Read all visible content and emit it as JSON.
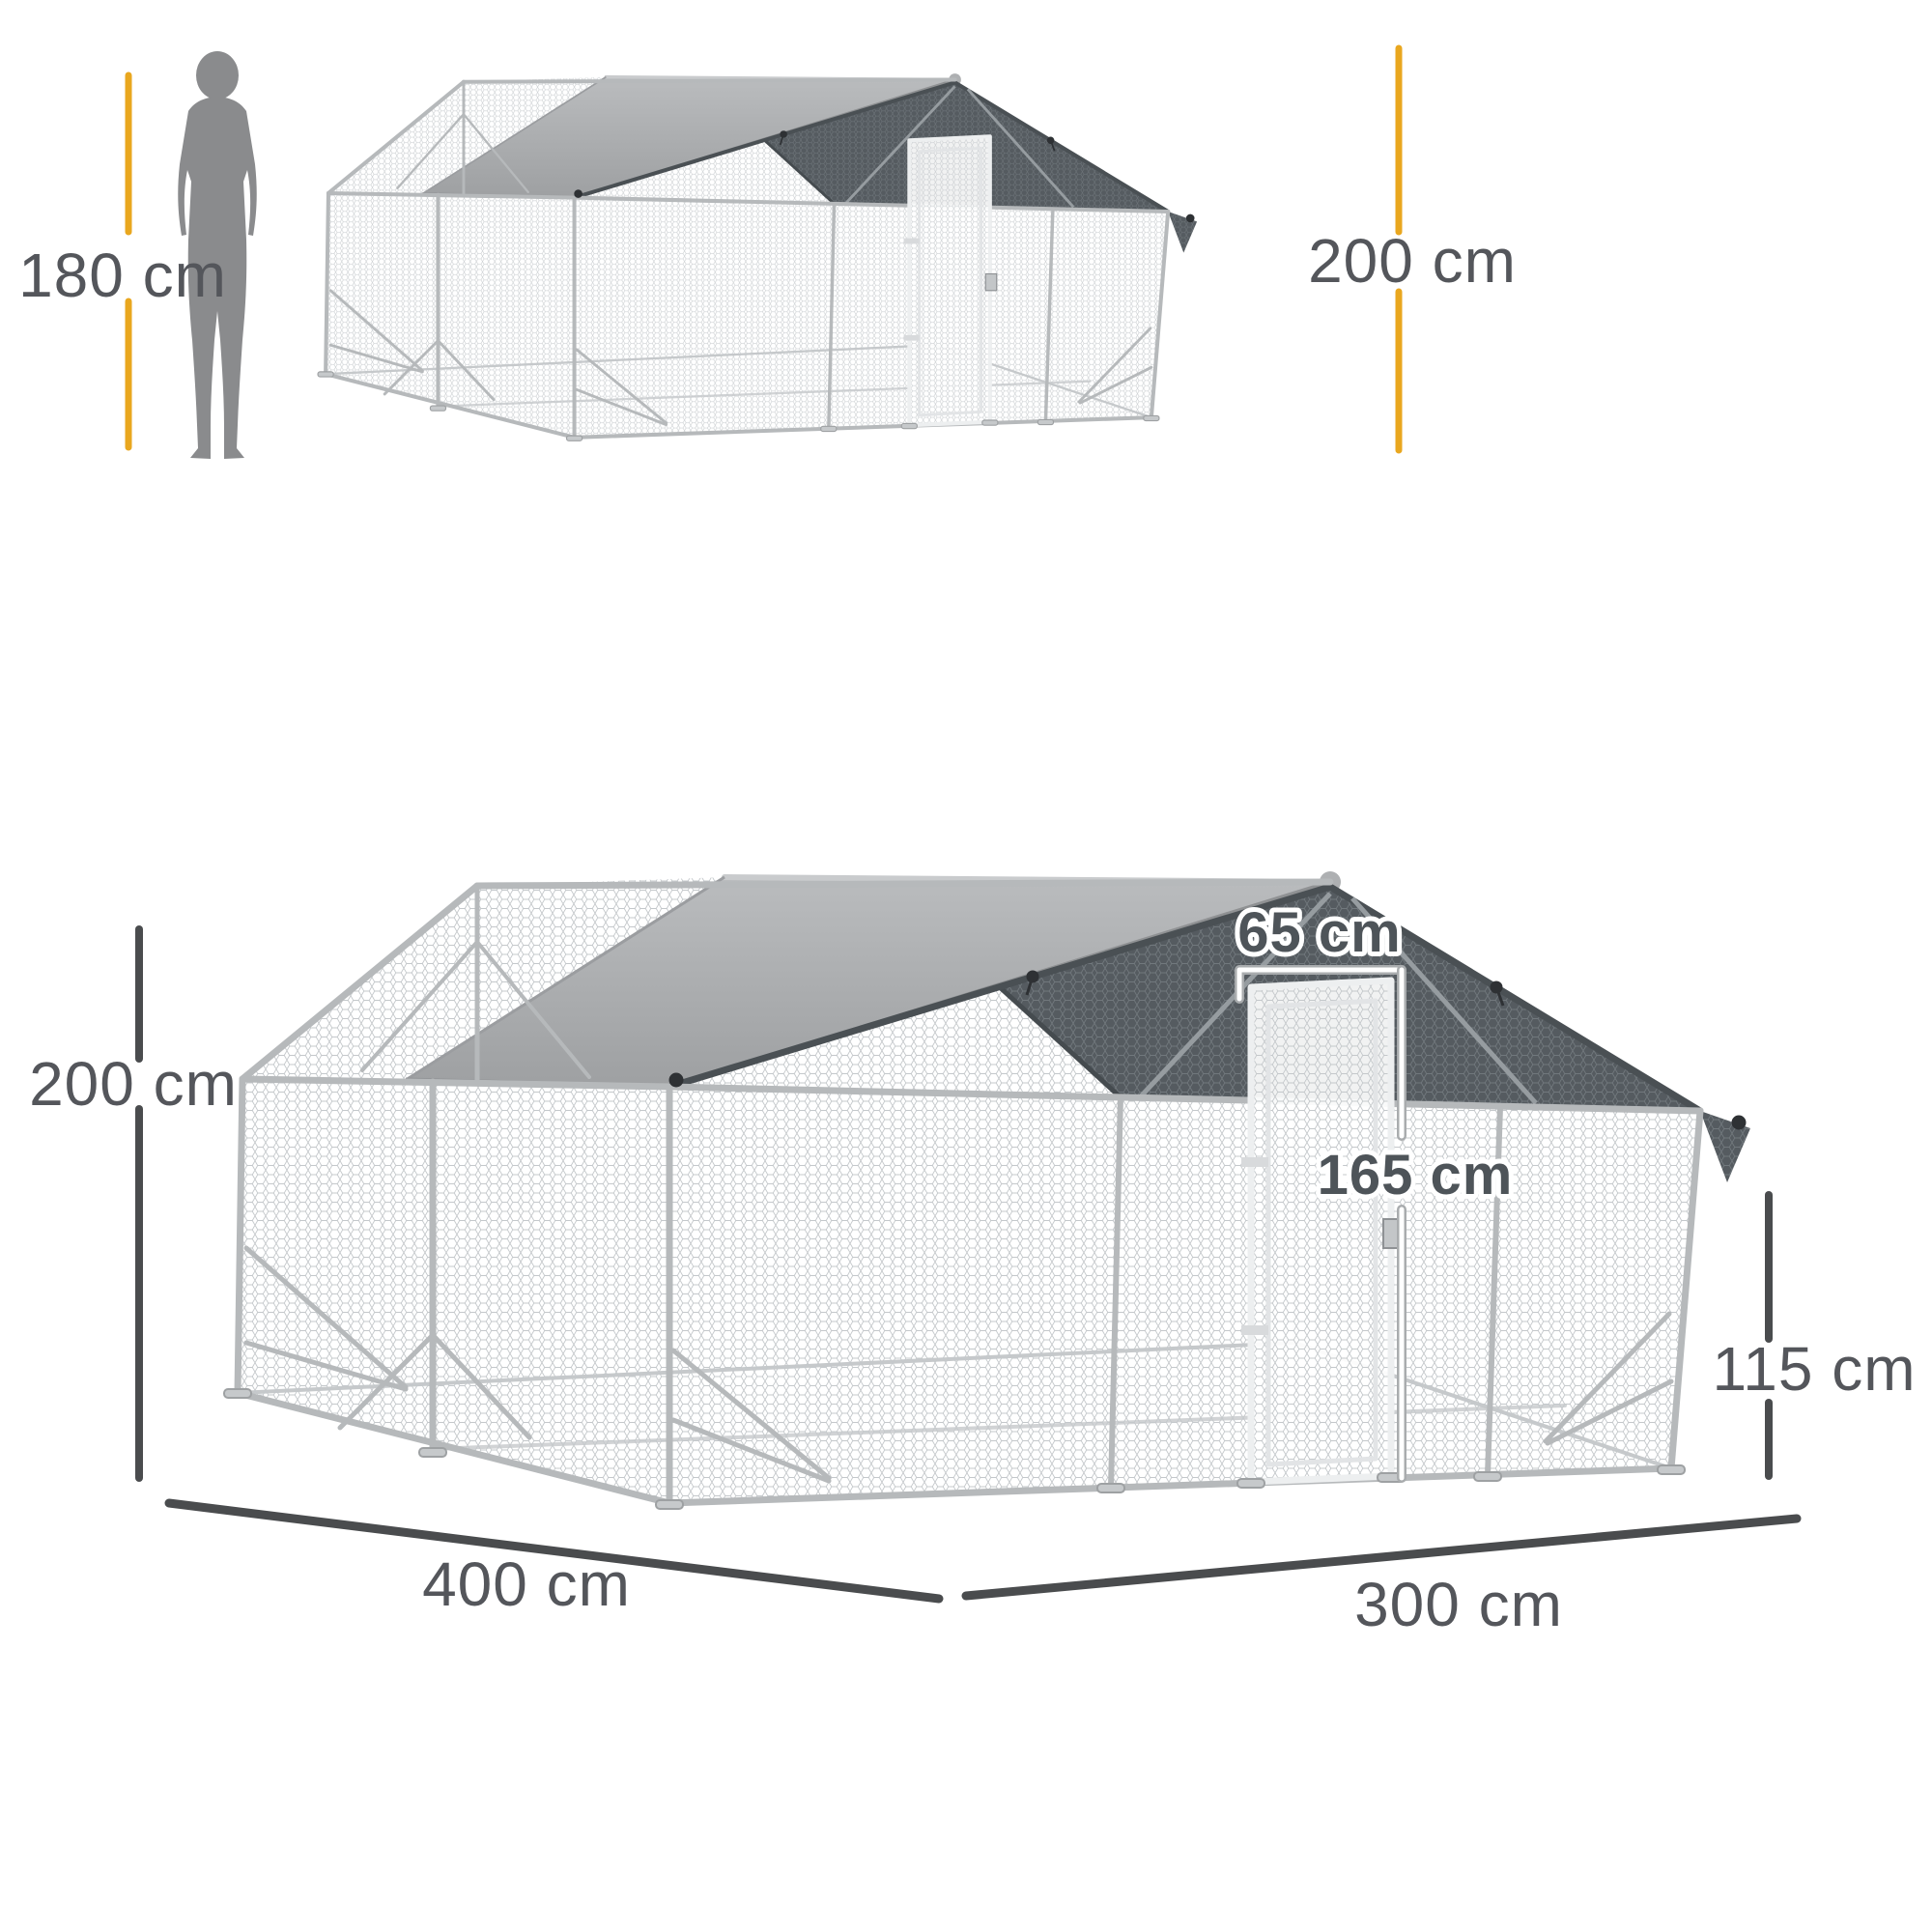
{
  "labels": {
    "person_height": "180 cm",
    "overall_height_small": "200 cm",
    "overall_height": "200 cm",
    "door_width": "65 cm",
    "door_height": "165 cm",
    "side_wall_height": "115 cm",
    "length": "400 cm",
    "width": "300 cm"
  },
  "colors": {
    "accent_yellow": "#E9A71F",
    "dimension_line": "#4A4C4E",
    "label_text": "#54565B",
    "tarp_gray": "#A8AAAC",
    "shade_cloth_dark": "#555B60",
    "mesh_wire": "#C4C8CB",
    "frame_tube": "#B6B9BB",
    "person_silhouette": "#8A8B8D"
  },
  "icons": {
    "person": "person-silhouette"
  }
}
